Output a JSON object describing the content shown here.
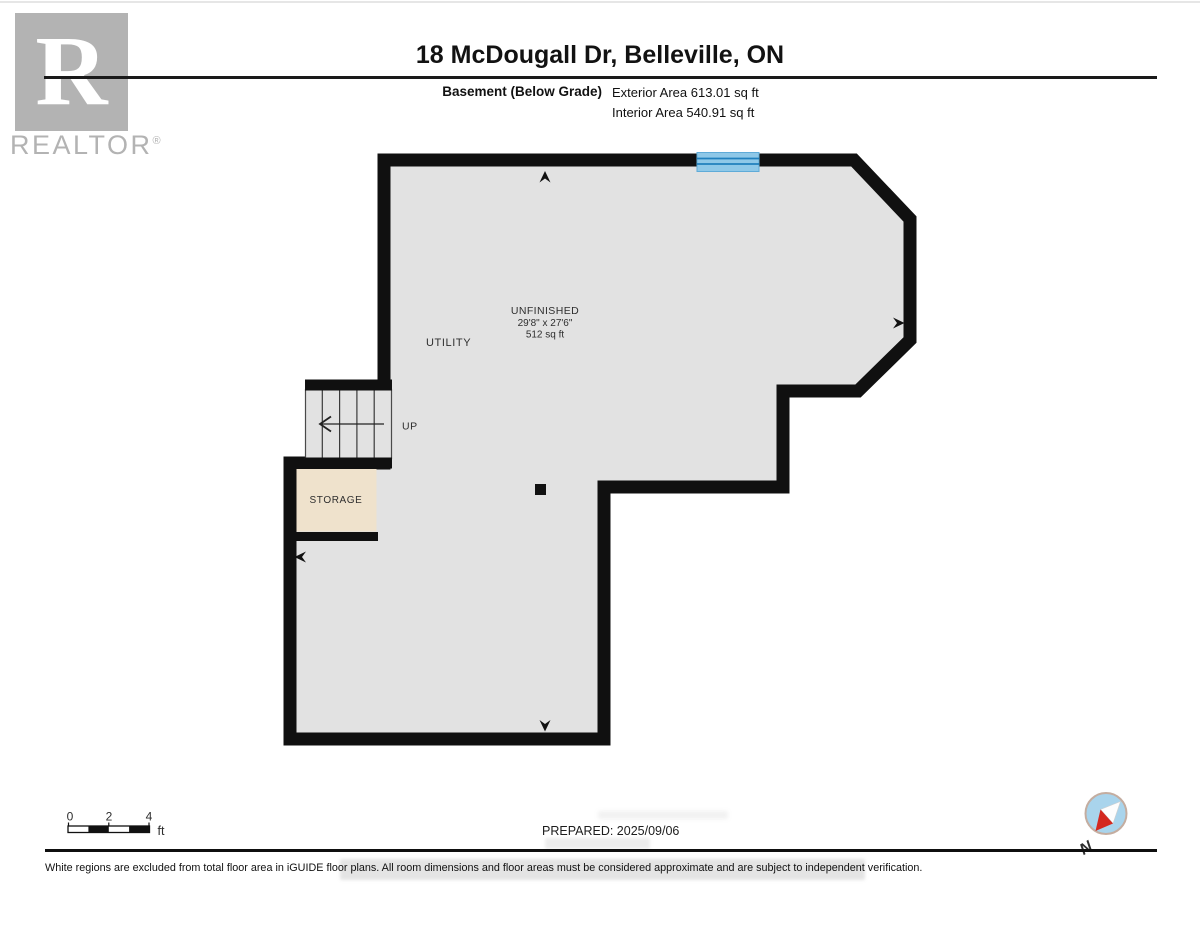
{
  "branding": {
    "logo_letter": "R",
    "wordmark": "REALTOR",
    "registered_mark": "®",
    "color": "#b3b3b3"
  },
  "header": {
    "title": "18 McDougall Dr, Belleville, ON",
    "floor_label": "Basement (Below Grade)",
    "exterior_area": "Exterior Area 613.01 sq ft",
    "interior_area": "Interior Area 540.91 sq ft"
  },
  "plan": {
    "rooms": {
      "unfinished": {
        "name": "UNFINISHED",
        "dimensions": "29'8\" x 27'6\"",
        "area": "512 sq ft"
      },
      "utility": {
        "name": "UTILITY"
      },
      "storage": {
        "name": "STORAGE"
      }
    },
    "stairs": {
      "direction_label": "UP"
    },
    "colors": {
      "wall": "#101010",
      "floor": "#e2e2e2",
      "storage_fill": "#efe2cc",
      "window_fill": "#8ec8e8",
      "window_frame": "#2080bd"
    }
  },
  "footer": {
    "scale_bar": {
      "tick_0": "0",
      "tick_2": "2",
      "tick_4": "4",
      "unit": "ft"
    },
    "prepared": "PREPARED: 2025/09/06",
    "compass": {
      "label": "N",
      "needle_red": "#d4281f",
      "dial_fill": "#a9d4ec",
      "dial_border": "#c4ada0"
    },
    "disclaimer": "White regions are excluded from total floor area in iGUIDE floor plans. All room dimensions and floor areas must be considered approximate and are subject to independent verification."
  }
}
